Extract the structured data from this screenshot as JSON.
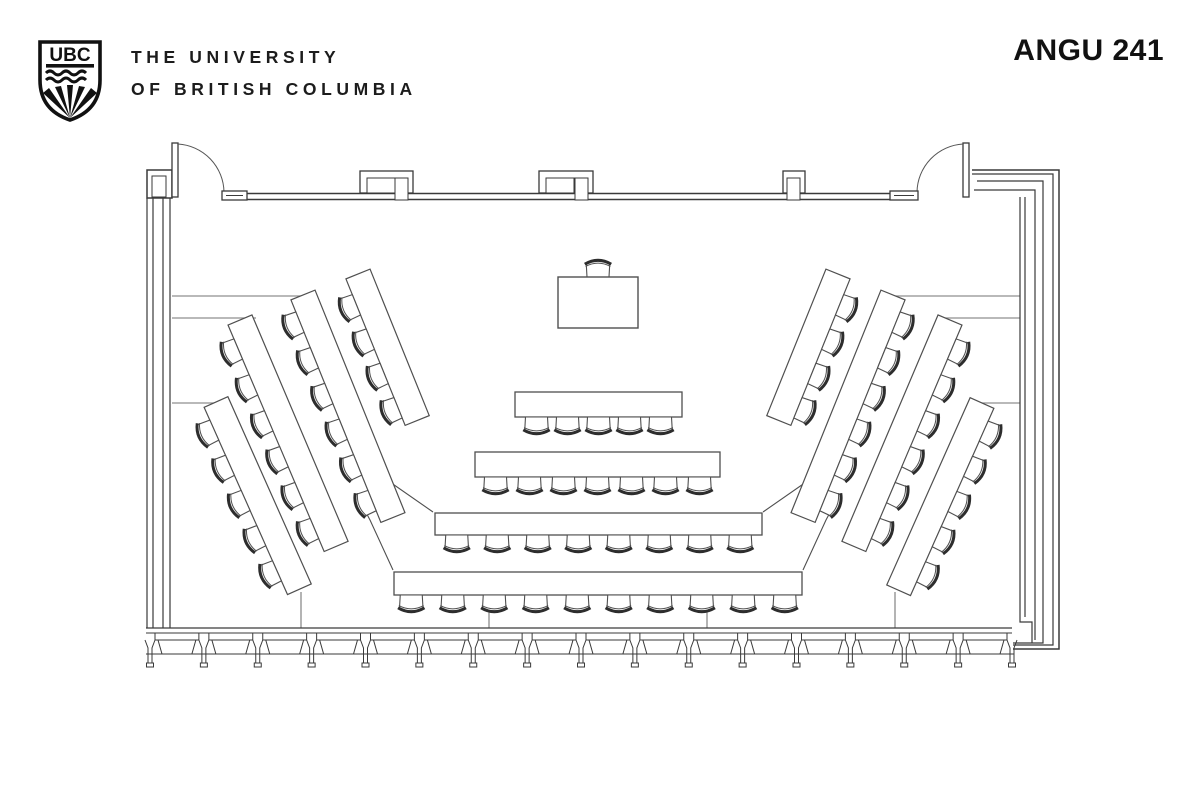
{
  "header": {
    "logo_text": "UBC",
    "university_name_line1": "THE UNIVERSITY",
    "university_name_line2": "OF BRITISH COLUMBIA",
    "room_label": "ANGU 241"
  },
  "floor_plan": {
    "podium": {
      "desks": 1,
      "chairs": 1
    },
    "center_rows": [
      {
        "seats": 5
      },
      {
        "seats": 7
      },
      {
        "seats": 8
      },
      {
        "seats": 10
      }
    ],
    "left_wing_rows": [
      {
        "seats": 4
      },
      {
        "seats": 6
      },
      {
        "seats": 6
      },
      {
        "seats": 5
      }
    ],
    "right_wing_rows": [
      {
        "seats": 4
      },
      {
        "seats": 6
      },
      {
        "seats": 6
      },
      {
        "seats": 5
      }
    ],
    "doors": 2,
    "colors": {
      "wall": "#3a3a3a",
      "furniture": "#4f4f4f",
      "tier_line": "#8f8f8f",
      "ink": "#2d2d2d",
      "background": "#ffffff",
      "text": "#1f1f1f"
    }
  }
}
